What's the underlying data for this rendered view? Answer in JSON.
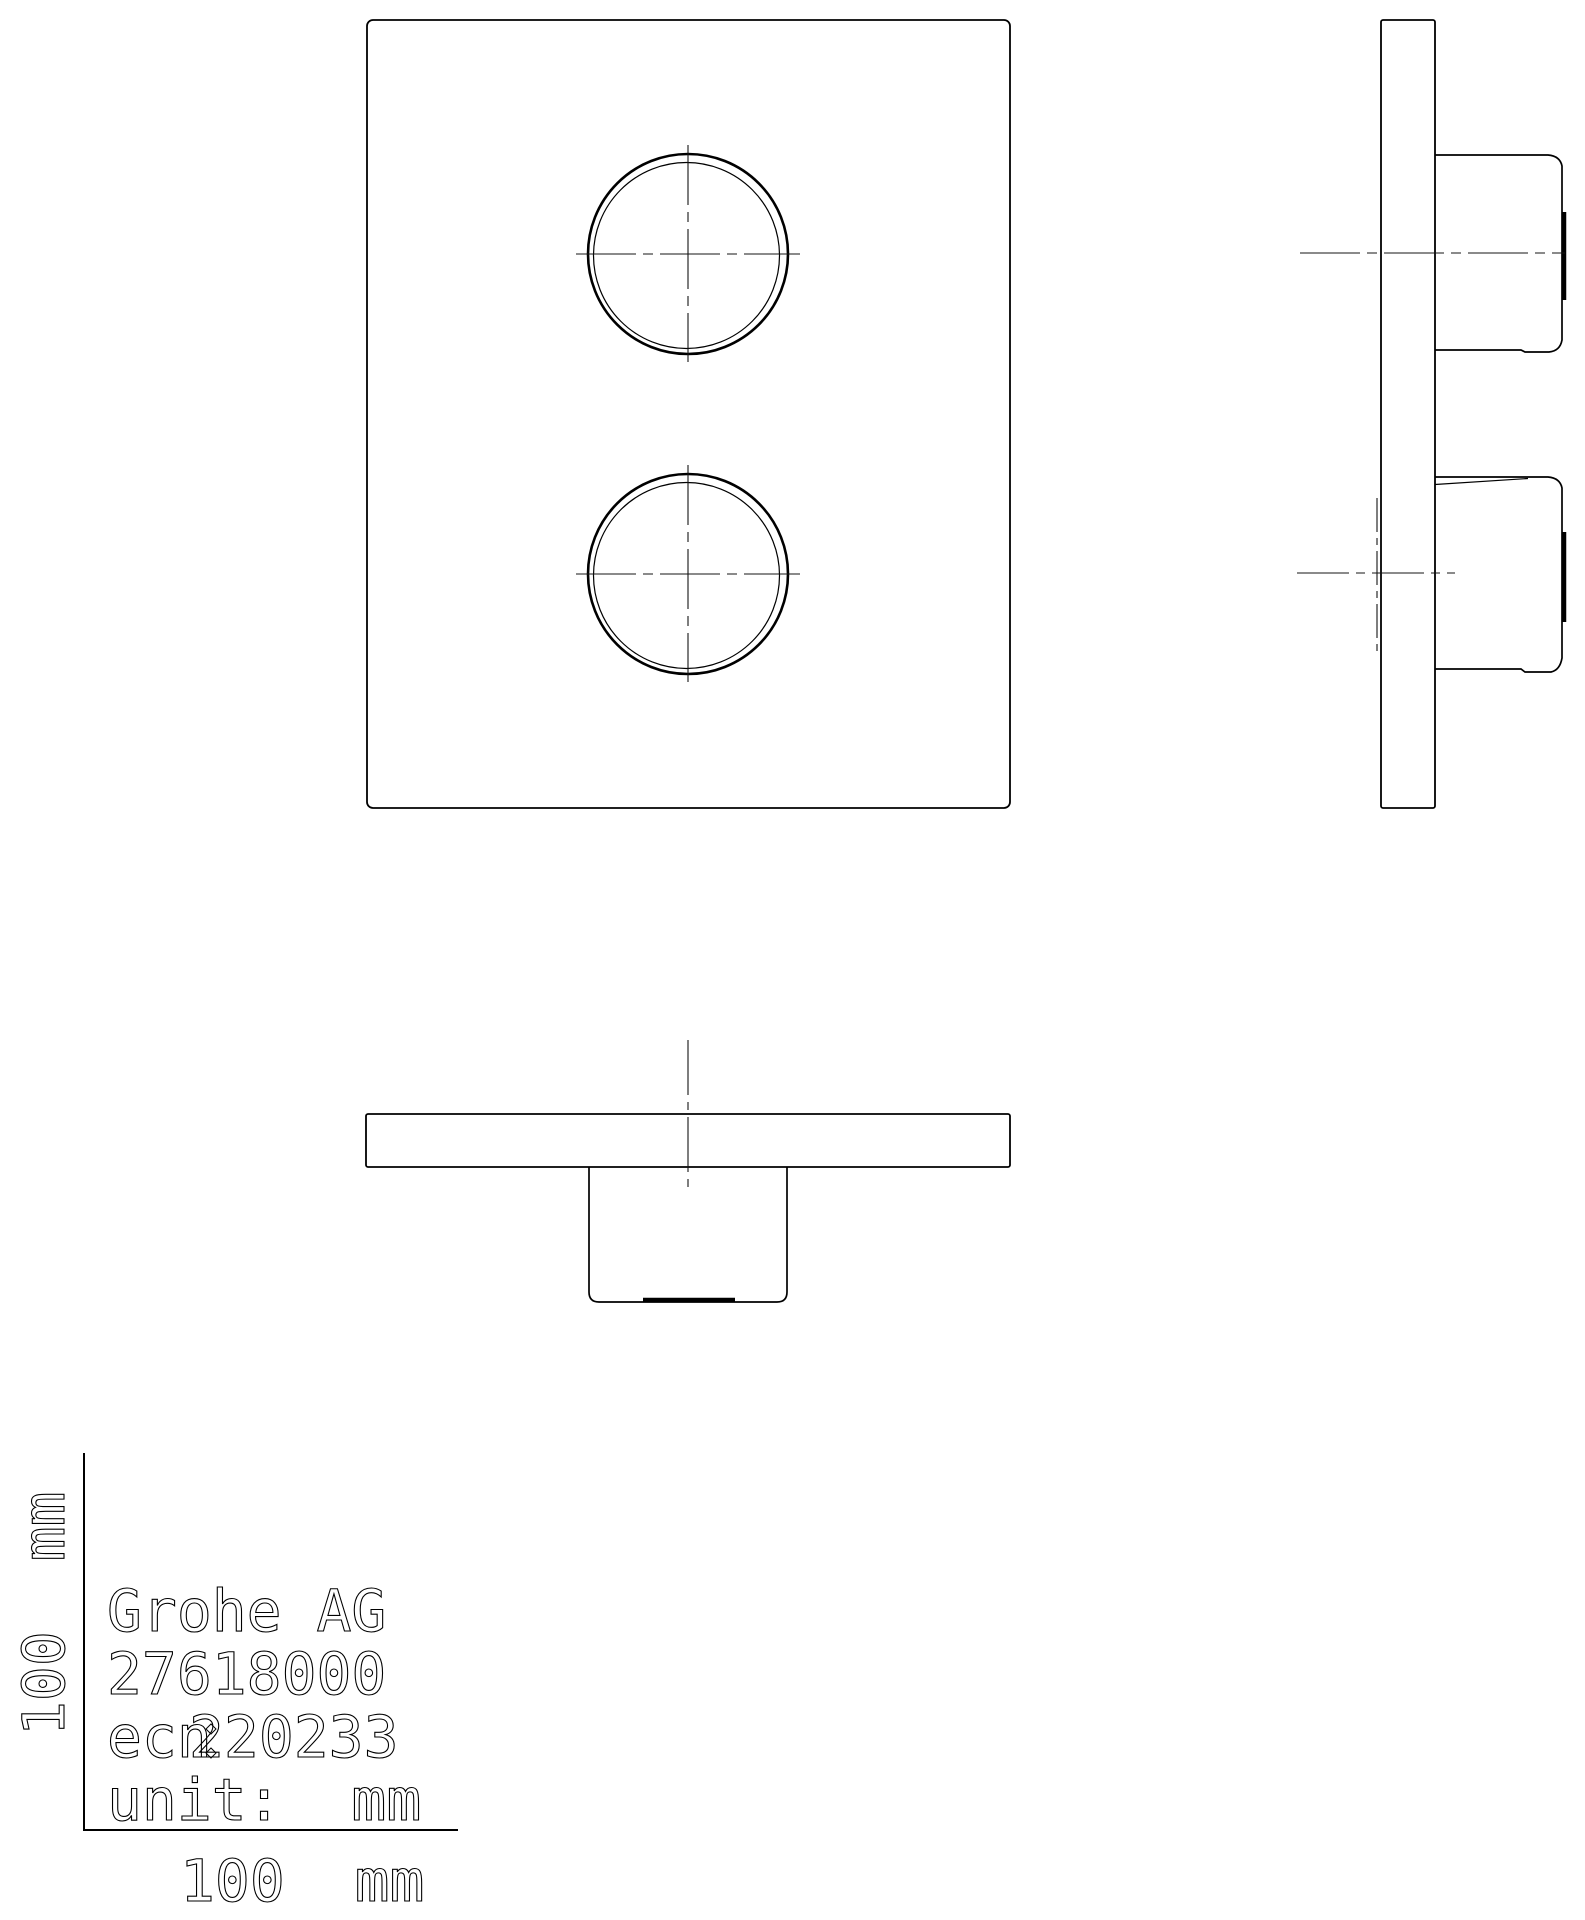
{
  "title_block": {
    "company": "Grohe AG",
    "product_number": "27618000",
    "ecn_prefix": "ecn",
    "ecn_number": "220233",
    "unit_label": "unit:  mm",
    "x_scale_label": "100  mm",
    "y_scale_label": "100  mm"
  },
  "drawing": {
    "canvas": {
      "width": 1585,
      "height": 1920,
      "background": "#ffffff",
      "line_color": "#000000",
      "centerline_color": "#141414",
      "text_stroke_color": "#000000",
      "font_size": 58,
      "text_stroke_width": 1.1
    },
    "views": {
      "front_view_label": "front-view",
      "side_view_label": "side-view",
      "bottom_view_label": "bottom-view",
      "scale_ruler_label": "scale-ruler",
      "title_block_label": "title-block"
    },
    "elements": [
      {
        "name": "front-plate-outline",
        "type": "rect",
        "x": 367,
        "y": 20,
        "w": 643,
        "h": 788,
        "rx": 6,
        "sw": 1.8
      },
      {
        "name": "front-knob-top-outer-circle",
        "type": "circle",
        "cx": 688,
        "cy": 254,
        "r": 100,
        "sw": 2.6
      },
      {
        "name": "front-knob-top-inner-circle",
        "type": "circle",
        "cx": 686.5,
        "cy": 255.5,
        "r": 93,
        "sw": 1.2
      },
      {
        "name": "front-knob-top-centerline-h",
        "type": "line",
        "x1": 576,
        "y1": 254,
        "x2": 800,
        "y2": 254,
        "sw": 1.1,
        "dash": "60 7 10 7",
        "center": true
      },
      {
        "name": "front-knob-top-centerline-v",
        "type": "line",
        "x1": 688,
        "y1": 145,
        "x2": 688,
        "y2": 362,
        "sw": 1.1,
        "dash": "60 7 10 7",
        "center": true
      },
      {
        "name": "front-knob-bottom-outer-circle",
        "type": "circle",
        "cx": 688,
        "cy": 574,
        "r": 100,
        "sw": 2.6
      },
      {
        "name": "front-knob-bottom-inner-circle",
        "type": "circle",
        "cx": 686.5,
        "cy": 575.5,
        "r": 93,
        "sw": 1.2
      },
      {
        "name": "front-knob-bottom-centerline-h",
        "type": "line",
        "x1": 576,
        "y1": 574,
        "x2": 800,
        "y2": 574,
        "sw": 1.1,
        "dash": "60 7 10 7",
        "center": true
      },
      {
        "name": "front-knob-bottom-centerline-v",
        "type": "line",
        "x1": 688,
        "y1": 465,
        "x2": 688,
        "y2": 682,
        "sw": 1.1,
        "dash": "60 7 10 7",
        "center": true
      },
      {
        "name": "side-plate-outline",
        "type": "rect",
        "x": 1381,
        "y": 20,
        "w": 54,
        "h": 788,
        "rx": 2,
        "sw": 1.8
      },
      {
        "name": "side-knob-top-outline",
        "type": "path",
        "d": "M 1435 155 H 1548 Q 1560 156 1562 166 V 340 Q 1560 351 1549 352 H 1525 L 1521 350 H 1435",
        "sw": 1.7
      },
      {
        "name": "side-knob-top-endcap",
        "type": "line",
        "x1": 1564,
        "y1": 212,
        "x2": 1564,
        "y2": 300,
        "sw": 4.5
      },
      {
        "name": "side-knob-top-centerline-h",
        "type": "line",
        "x1": 1300,
        "y1": 253,
        "x2": 1565,
        "y2": 253,
        "sw": 1.1,
        "dash": "60 7 10 7",
        "center": true
      },
      {
        "name": "side-knob-bottom-outline",
        "type": "path",
        "d": "M 1435 477 H 1548 Q 1560 478 1562 488 V 658 Q 1560 670 1551 672 H 1525 L 1521 669 H 1435",
        "sw": 1.7
      },
      {
        "name": "side-knob-bottom-chamfer-line",
        "type": "line",
        "x1": 1435,
        "y1": 484.5,
        "x2": 1528,
        "y2": 478.5,
        "sw": 1.2
      },
      {
        "name": "side-knob-bottom-endcap",
        "type": "line",
        "x1": 1564,
        "y1": 532,
        "x2": 1564,
        "y2": 622,
        "sw": 4.5
      },
      {
        "name": "side-knob-bottom-centerline-h",
        "type": "line",
        "x1": 1297,
        "y1": 573,
        "x2": 1455,
        "y2": 573,
        "sw": 1.1,
        "dash": "52 7 9 7",
        "center": true
      },
      {
        "name": "side-knob-bottom-centerline-v",
        "type": "line",
        "x1": 1377,
        "y1": 498,
        "x2": 1377,
        "y2": 652,
        "sw": 1.1,
        "dash": "34 6 7 6",
        "center": true
      },
      {
        "name": "bottom-plate-outline",
        "type": "rect",
        "x": 366,
        "y": 1114,
        "w": 644,
        "h": 53,
        "rx": 2,
        "sw": 1.8
      },
      {
        "name": "bottom-knob-outline",
        "type": "path",
        "d": "M 589 1167 V 1292 Q 589 1302 599 1302 H 777 Q 787 1302 787 1292 V 1167",
        "sw": 1.7
      },
      {
        "name": "bottom-knob-endcap",
        "type": "line",
        "x1": 643,
        "y1": 1300,
        "x2": 735,
        "y2": 1300,
        "sw": 4.5
      },
      {
        "name": "bottom-knob-centerline-v",
        "type": "line",
        "x1": 688,
        "y1": 1040,
        "x2": 688,
        "y2": 1188,
        "sw": 1.1,
        "dash": "55 7 8 7",
        "center": true
      },
      {
        "name": "scale-ruler-y-axis-line",
        "type": "line",
        "x1": 84,
        "y1": 1453,
        "x2": 84,
        "y2": 1831,
        "sw": 2
      },
      {
        "name": "scale-ruler-x-axis-line",
        "type": "line",
        "x1": 84,
        "y1": 1830,
        "x2": 458,
        "y2": 1830,
        "sw": 2
      },
      {
        "name": "scale-ruler-y-label",
        "type": "text",
        "x": 0,
        "y": 0,
        "transform": "translate(64 1736) rotate(-90)",
        "bind": "title_block.y_scale_label"
      },
      {
        "name": "scale-ruler-x-label",
        "type": "text",
        "x": 180,
        "y": 1901,
        "bind": "title_block.x_scale_label"
      },
      {
        "name": "title-company-text",
        "type": "text",
        "x": 107,
        "y": 1631,
        "bind": "title_block.company"
      },
      {
        "name": "title-product-number-text",
        "type": "text",
        "x": 107,
        "y": 1694,
        "bind": "title_block.product_number"
      },
      {
        "name": "title-ecn-prefix-text",
        "type": "text",
        "x": 107,
        "y": 1757,
        "bind": "title_block.ecn_prefix"
      },
      {
        "name": "title-ecn-number-text",
        "type": "text",
        "x": 189,
        "y": 1757,
        "bind": "title_block.ecn_number"
      },
      {
        "name": "title-unit-text",
        "type": "text",
        "x": 107,
        "y": 1820,
        "bind": "title_block.unit_label"
      },
      {
        "name": "ecn-artifact-diamond-top",
        "type": "path",
        "d": "M 211 1724 L 216 1729 L 211 1734 L 206 1729 Z",
        "sw": 1
      },
      {
        "name": "ecn-artifact-diamond-bottom",
        "type": "path",
        "d": "M 211 1748 L 216 1753 L 211 1758 L 206 1753 Z",
        "sw": 1
      }
    ]
  }
}
